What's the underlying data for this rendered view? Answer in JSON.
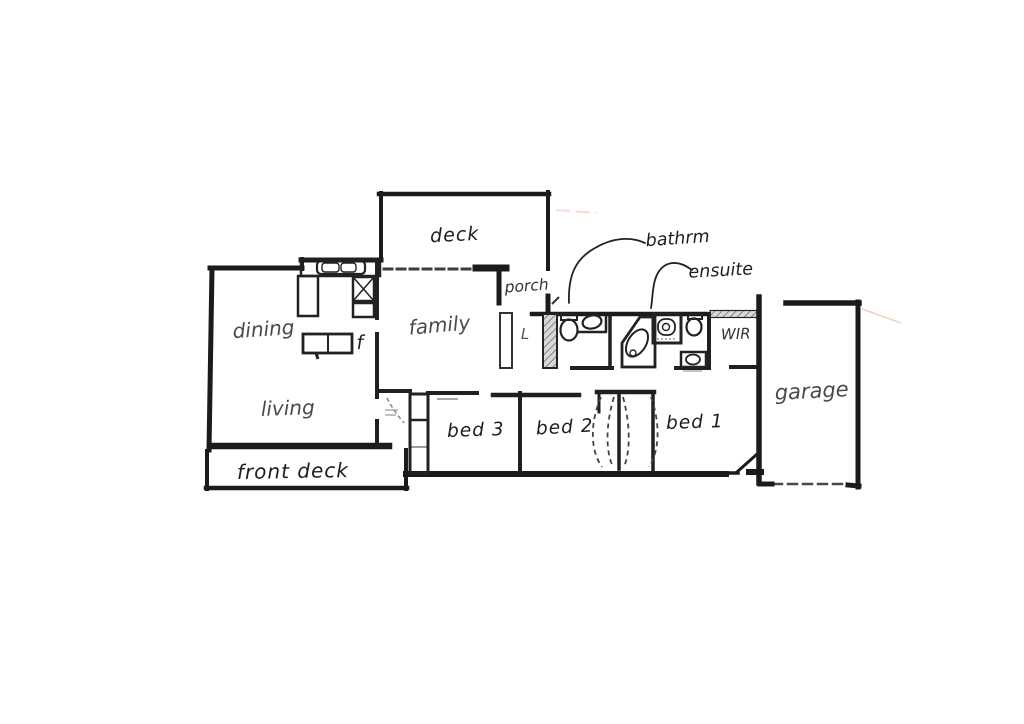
{
  "figure": {
    "kind": "hand-drawn floor plan sketch",
    "colors": {
      "ink": "#1d1d1d",
      "pencil": "#4a4a4a",
      "paper": "#ffffff",
      "hatch": "#8a8a8a",
      "artifact_pink": "#f0bfae"
    }
  },
  "labels": {
    "deck": "deck",
    "porch": "porch",
    "bathroom": "bathrm",
    "ensuite": "ensuite",
    "wir": "WIR",
    "garage": "garage",
    "dining": "dining",
    "family": "family",
    "linen": "L",
    "fridge": "f",
    "living": "living",
    "front_deck": "front deck",
    "bed1": "bed 1",
    "bed2": "bed 2",
    "bed3": "bed 3"
  }
}
